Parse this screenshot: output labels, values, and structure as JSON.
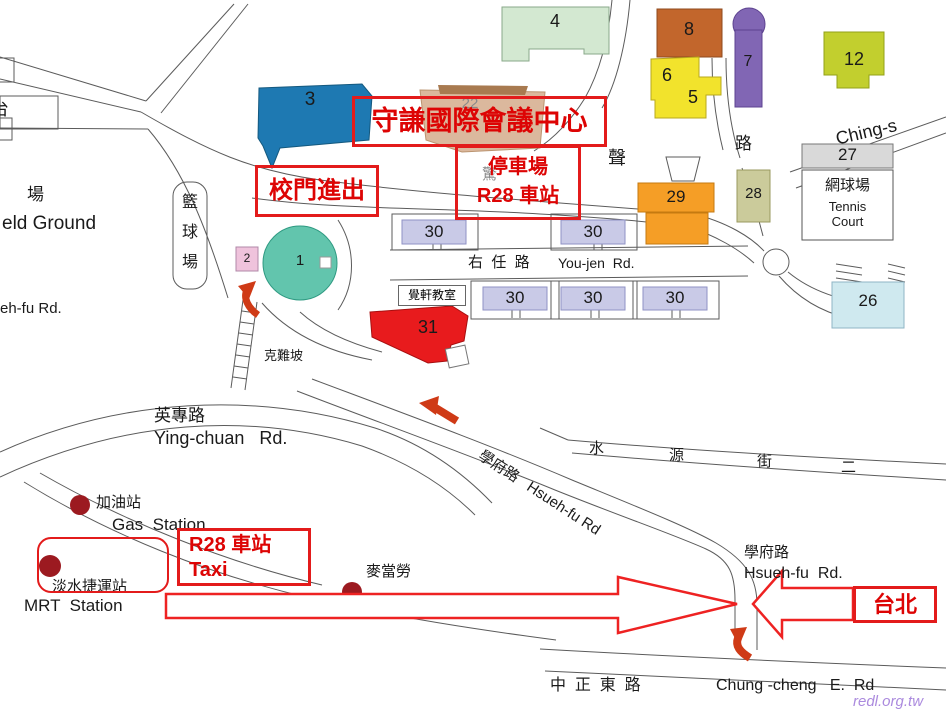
{
  "annotations": {
    "conference_center": "守謙國際會議中心",
    "gate_access": "校門進出",
    "parking_line1": "停車場",
    "parking_line2": "R28 車站",
    "r28_taxi_line1": "R28 車站",
    "r28_taxi_line2": "Taxi",
    "taipei": "台北"
  },
  "buildings": {
    "b1": "1",
    "b2": "2",
    "b3": "3",
    "b4": "4",
    "b5": "5",
    "b6": "6",
    "b7": "7",
    "b8": "8",
    "b12": "12",
    "b22": "22",
    "b26": "26",
    "b27": "27",
    "b28": "28",
    "b29": "29",
    "b30": "30",
    "b31": "31"
  },
  "places": {
    "left_partial": "台",
    "field_zh": "場",
    "field_en": "eld Ground",
    "basketball_1": "籃",
    "basketball_2": "球",
    "basketball_3": "場",
    "tennis_zh": "網球場",
    "tennis_en_1": "Tennis",
    "tennis_en_2": "Court",
    "chueh_hsuan_classroom": "覺軒教室",
    "ke_nan_slope": "克難坡",
    "ching_sheng_partial": "驚",
    "ching_sheng": "聲",
    "gas_zh": "加油站",
    "gas_en": "Gas  Station",
    "mrt_zh": "淡水捷運站",
    "mrt_en": "MRT  Station",
    "mcdonalds_zh": "麥當勞"
  },
  "roads": {
    "youjen_zh": "右  任  路",
    "youjen_en": "You-jen  Rd.",
    "yingchuan_zh": "英專路",
    "yingchuan_en": "Ying-chuan   Rd.",
    "hsuehfu_diag": "學府路   Hsueh-fu Rd",
    "hsuehfu_left_partial": "eh-fu Rd.",
    "hsuehfu_right_zh": "學府路",
    "hsuehfu_right_en": "Hsueh-fu  Rd.",
    "shuiyuan_c1": "水",
    "shuiyuan_c2": "源",
    "shuiyuan_c3": "街",
    "shuiyuan_c4": "二",
    "lu": "路",
    "ching_sheng_road": "Ching-s",
    "zhongzheng_zh": "中  正  東  路",
    "zhongzheng_en": "Chung -cheng   E.  Rd"
  },
  "watermark": "redl.org.tw",
  "colors": {
    "annotation_red": "#e31b1b",
    "marker_dot": "#9c1a20",
    "curved_arrow": "#cf3a16"
  }
}
